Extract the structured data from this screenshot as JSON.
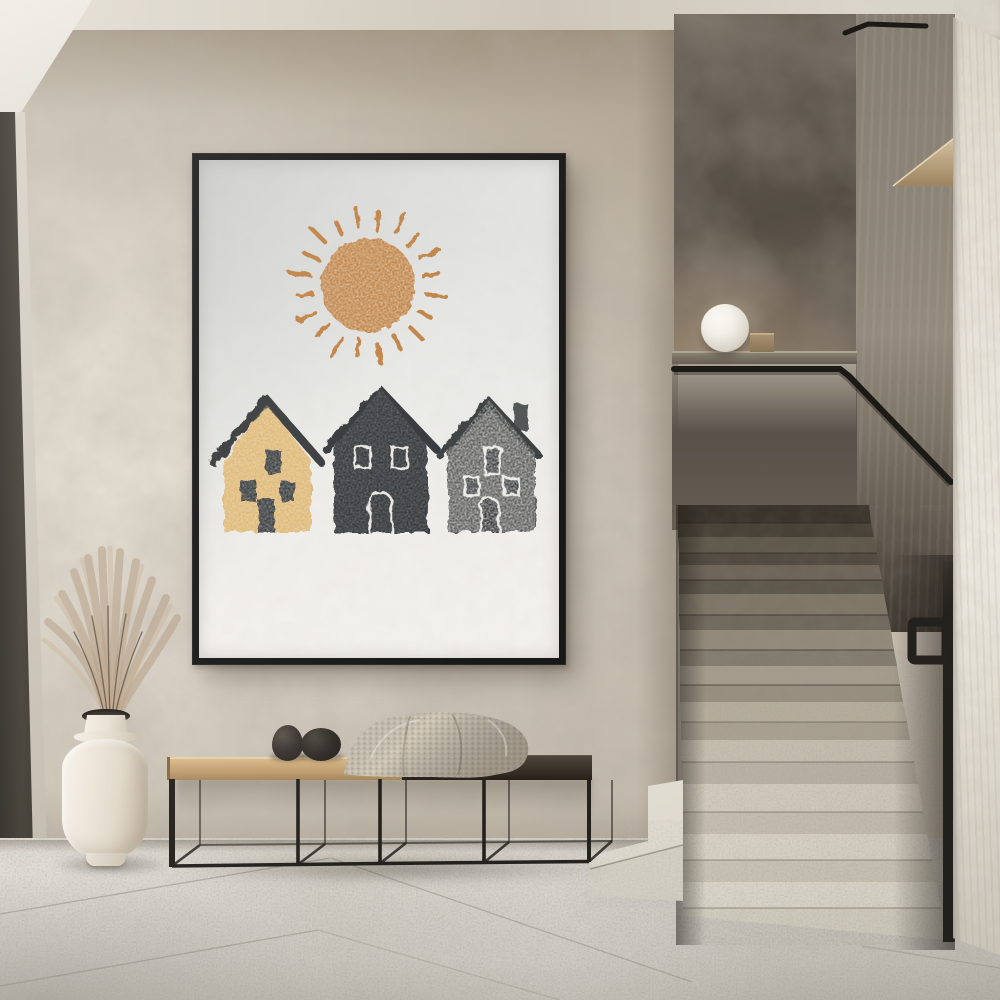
{
  "scene": {
    "title": "Minimalist hallway interior with framed block-print poster, ceramic vase of dried pampas grass, metal-frame bench and terrazzo staircase",
    "width": 1000,
    "height": 1000
  },
  "colors": {
    "wall": "#c6bdaf",
    "ceiling": "#d8d2c8",
    "floor": "#d3cfc7",
    "doorframe": "#3c3931",
    "panel": "#5c554c",
    "wallmid": "#8d8478",
    "rightwall": "#e7e2d9",
    "frame": "#181818",
    "paper": "#ebebe8",
    "sun": "#c08347",
    "house1": "#dfb874",
    "house1roof": "#393a3c",
    "house2": "#35383a",
    "house3": "#5e605f",
    "house3roof": "#3d3f41",
    "rail": "#1c1a17",
    "seatwood": "#c9a877",
    "seatdark": "#342c25",
    "blanket": "#cbc2b2",
    "vase": "#ece5d8",
    "grass": "#b29a82",
    "stone": "#332e29",
    "steplight": "#dcd6ca",
    "trim": "#23211d",
    "lamp": "#f2efe8"
  },
  "poster": {
    "description": "Block-print style art: textured orange sun above a row of three stamped houses on off-white paper in a thin black frame",
    "sun": {
      "color": "#c08347",
      "ray_count": 20
    },
    "houses": [
      {
        "style": "tan house, dark outlined roof, solid dark windows and door",
        "body_color": "#dfb874",
        "roof_color": "#393a3c",
        "windows": 3
      },
      {
        "style": "charcoal silhouette house, white outlined windows and arched door",
        "body_color": "#35383a",
        "roof_color": "#34373a",
        "windows": 2
      },
      {
        "style": "speckled grey house with chimney, white outlined windows and arched door",
        "body_color": "#5e605f",
        "roof_color": "#3d3f41",
        "windows": 3
      }
    ]
  },
  "staircase": {
    "visible_steps": 10,
    "tread_material": "terrazzo",
    "handrail_color": "#1c1a17",
    "upper_wall_color": "#5c554c",
    "lamp": {
      "shape": "sphere",
      "color": "#f2efe8"
    }
  },
  "furniture": {
    "bench": {
      "frame_color": "#24211d",
      "seat_left_color": "#c9a877",
      "seat_right_color": "#342c25",
      "front_posts": 5
    },
    "blanket": {
      "material": "knitted",
      "color": "#cbc2b2"
    },
    "decor_stones": 2,
    "vase": {
      "color": "#ece5d8",
      "contents": "dried pampas grass",
      "grass_color": "#b29a82"
    }
  },
  "architecture": {
    "left_door_frame_color": "#3c3931",
    "floor_material": "large stone tiles",
    "wall_finish": "textured plaster"
  }
}
